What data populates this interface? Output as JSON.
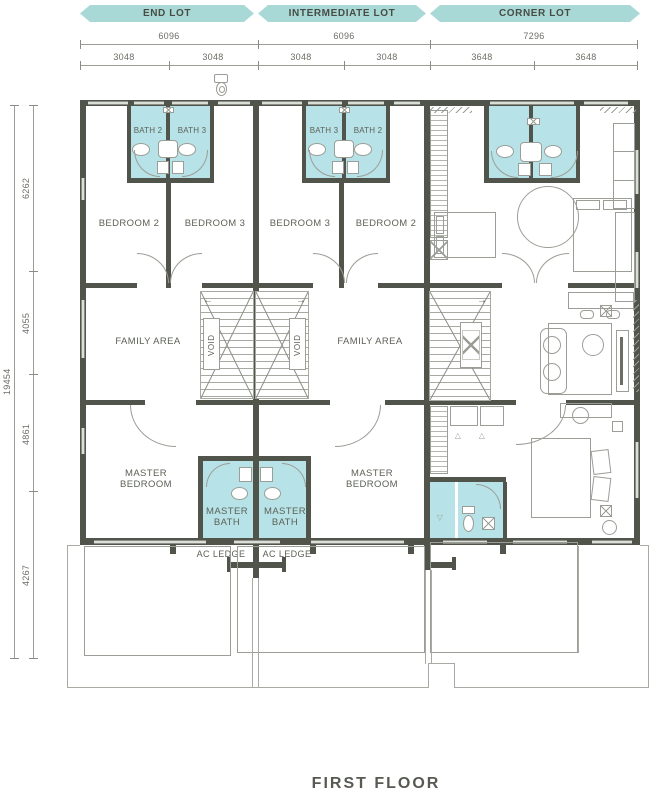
{
  "title": "FIRST FLOOR",
  "colors": {
    "banner_teal": "#a9d9d6",
    "bath_teal": "#b7e3e8",
    "wall_gray": "#50544b",
    "line_gray": "#9b9e96",
    "text_gray": "#5d6156"
  },
  "banners": {
    "end_lot": "END LOT",
    "intermediate_lot": "INTERMEDIATE LOT",
    "corner_lot": "CORNER LOT"
  },
  "dimensions": {
    "horizontal_overall": [
      "6096",
      "6096",
      "7296"
    ],
    "horizontal_halves": [
      "3048",
      "3048",
      "3048",
      "3048",
      "3648",
      "3648"
    ],
    "vertical_overall": "19454",
    "vertical_segments": [
      "6262",
      "4055",
      "4861",
      "4267"
    ]
  },
  "end_lot": {
    "bath2": "BATH 2",
    "bath3": "BATH 3",
    "bedroom2": "BEDROOM 2",
    "bedroom3": "BEDROOM 3",
    "family_area": "FAMILY AREA",
    "void": "VOID",
    "master_bedroom": "MASTER BEDROOM",
    "master_bath": "MASTER BATH",
    "ac_ledge": "AC LEDGE"
  },
  "intermediate_lot": {
    "bath3": "BATH 3",
    "bath2": "BATH 2",
    "bedroom3": "BEDROOM 3",
    "bedroom2": "BEDROOM 2",
    "family_area": "FAMILY AREA",
    "void": "VOID",
    "master_bedroom": "MASTER BEDROOM",
    "master_bath": "MASTER BATH",
    "ac_ledge": "AC LEDGE"
  }
}
